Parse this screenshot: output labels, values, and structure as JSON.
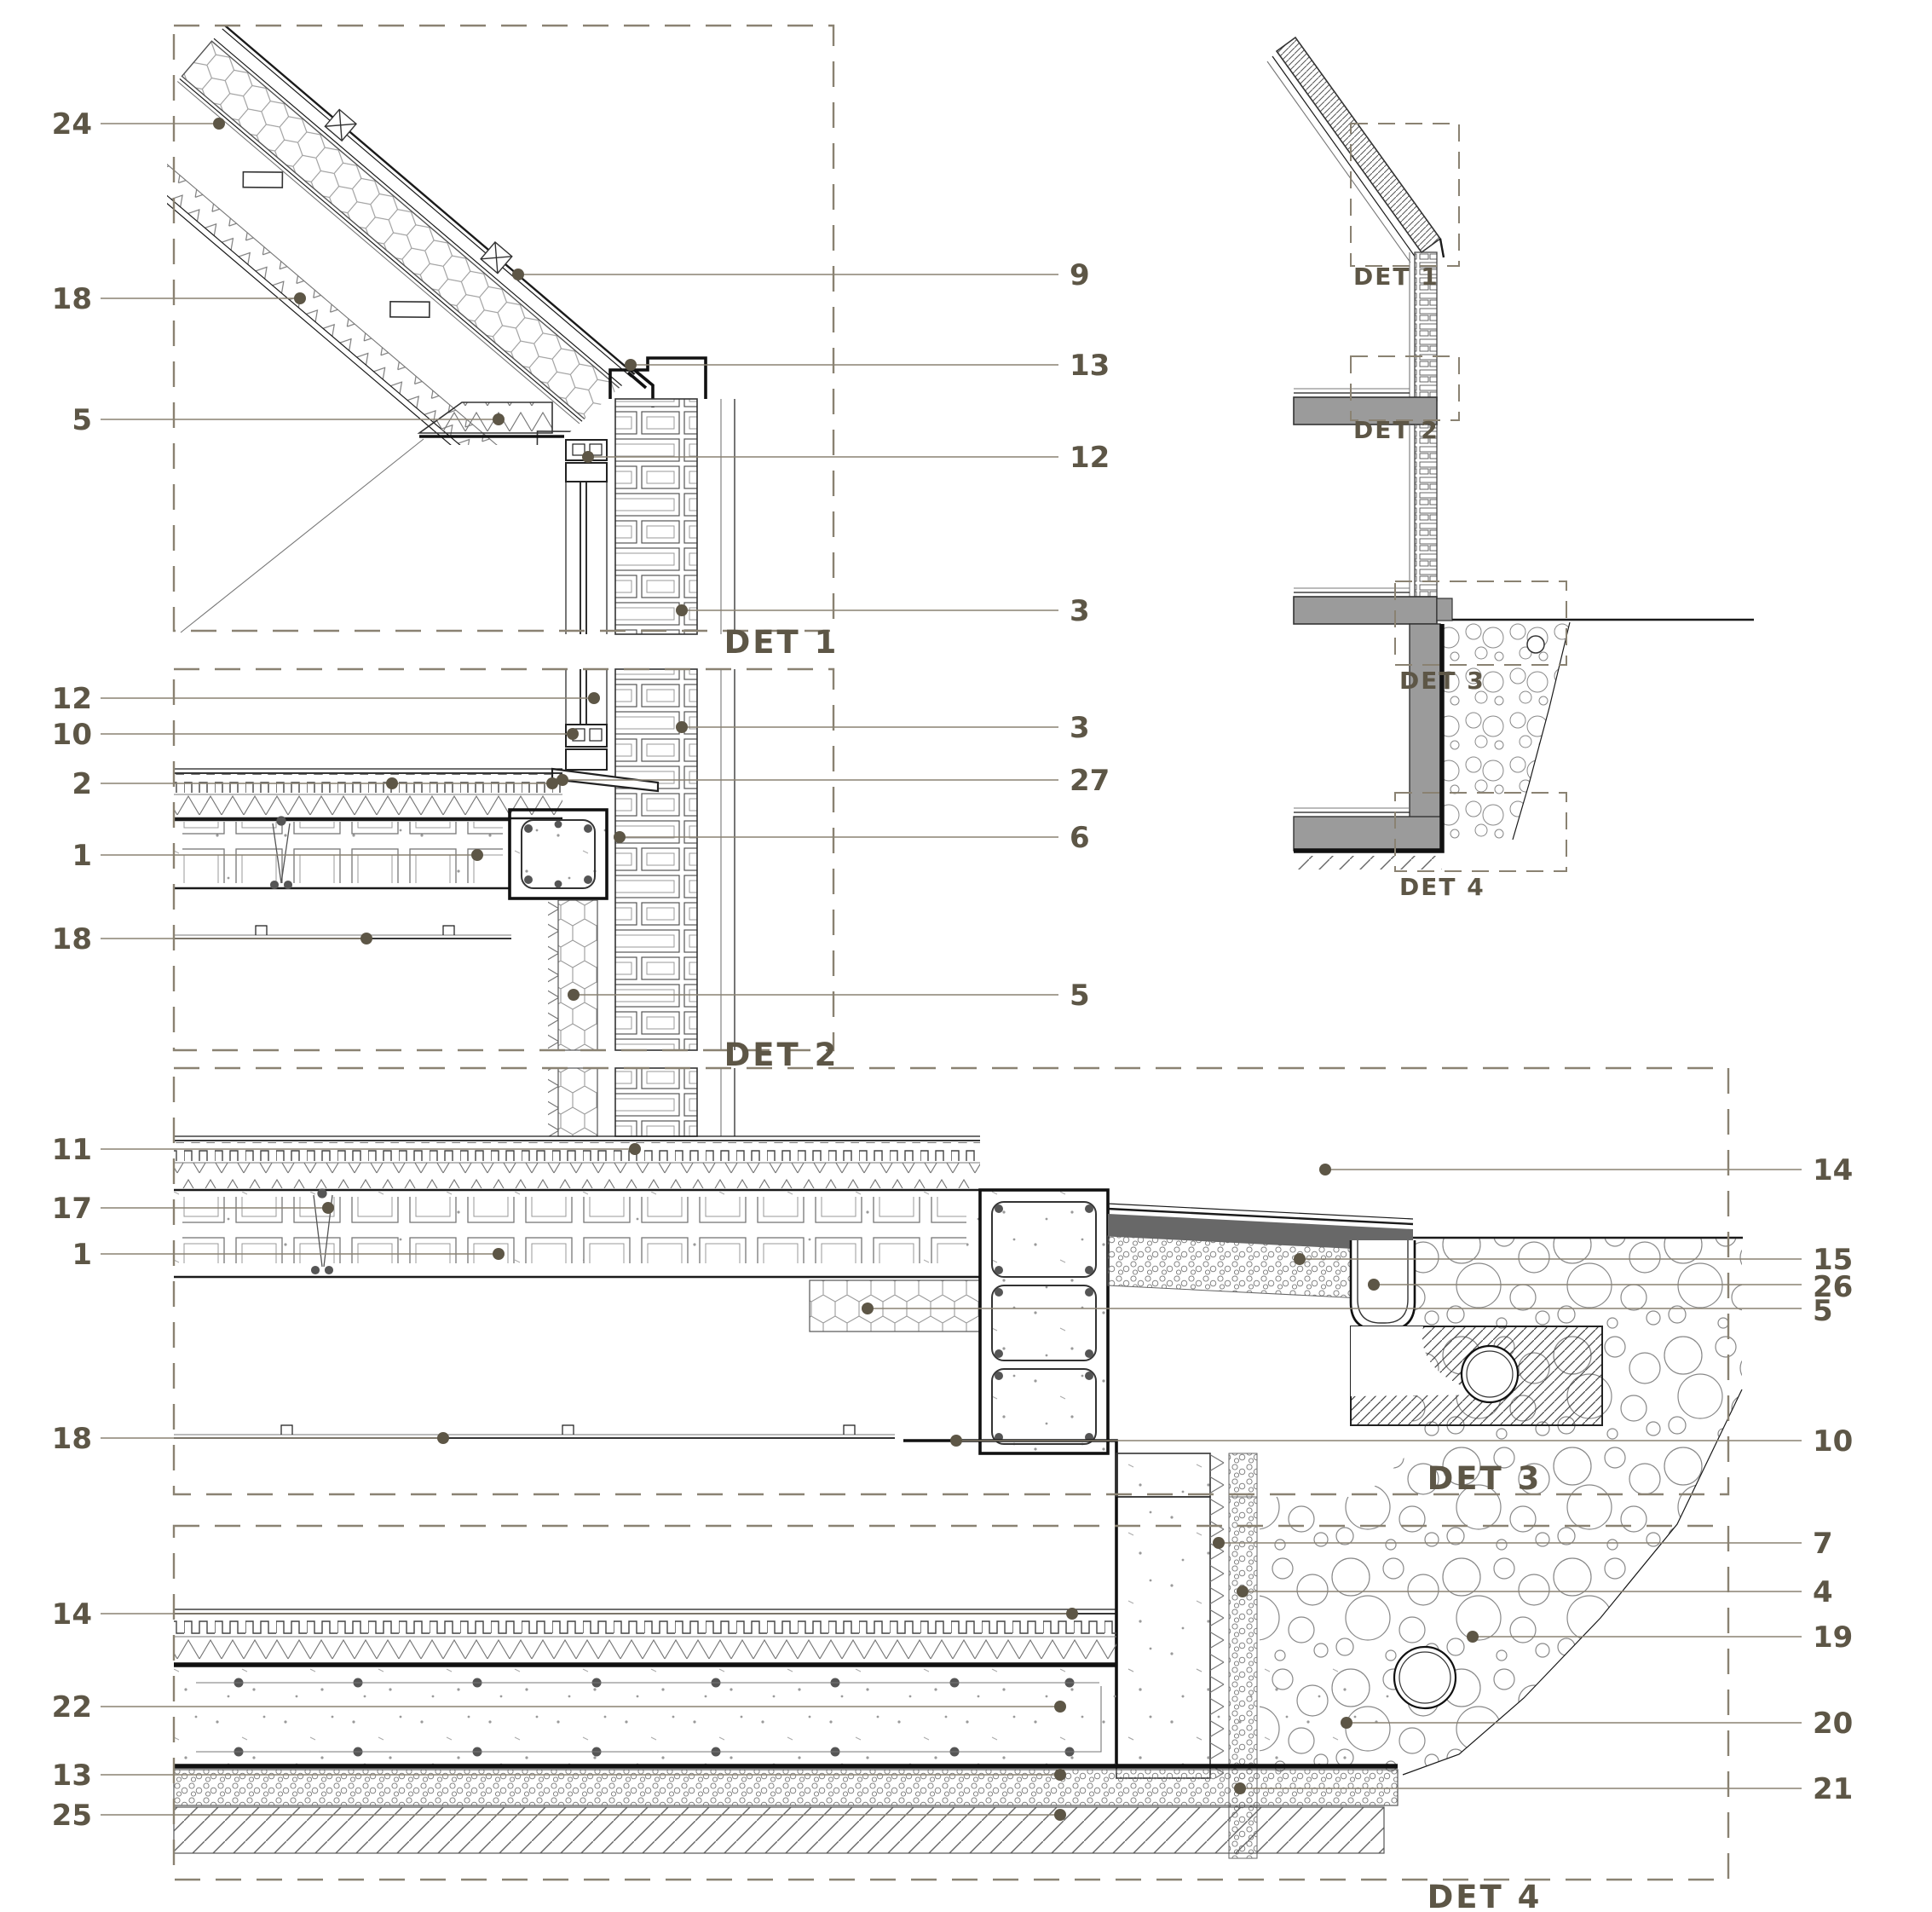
{
  "sheet": {
    "type": "architectural-construction-details",
    "colors": {
      "label": "#5d5646",
      "leader": "#8a8272",
      "linework": "#1a1a1a",
      "dash_border": "#8a8272",
      "slab_fill": "#9b9b9b",
      "waterproof_fill": "#686868",
      "background": "#ffffff"
    }
  },
  "captions": {
    "det1": "DET 1",
    "det2": "DET 2",
    "det3": "DET 3",
    "det4": "DET 4",
    "key_det1": "DET 1",
    "key_det2": "DET 2",
    "key_det3": "DET 3",
    "key_det4": "DET 4"
  },
  "callouts": [
    {
      "text": "24",
      "detail": "DET 1",
      "side": "left"
    },
    {
      "text": "18",
      "detail": "DET 1",
      "side": "left"
    },
    {
      "text": "5",
      "detail": "DET 1",
      "side": "left"
    },
    {
      "text": "12",
      "detail": "DET 2",
      "side": "left"
    },
    {
      "text": "10",
      "detail": "DET 2",
      "side": "left"
    },
    {
      "text": "2",
      "detail": "DET 2",
      "side": "left"
    },
    {
      "text": "1",
      "detail": "DET 2",
      "side": "left"
    },
    {
      "text": "18",
      "detail": "DET 2",
      "side": "left"
    },
    {
      "text": "11",
      "detail": "DET 3",
      "side": "left"
    },
    {
      "text": "17",
      "detail": "DET 3",
      "side": "left"
    },
    {
      "text": "1",
      "detail": "DET 3",
      "side": "left"
    },
    {
      "text": "18",
      "detail": "DET 3",
      "side": "left"
    },
    {
      "text": "14",
      "detail": "DET 4",
      "side": "left"
    },
    {
      "text": "22",
      "detail": "DET 4",
      "side": "left"
    },
    {
      "text": "13",
      "detail": "DET 4",
      "side": "left"
    },
    {
      "text": "25",
      "detail": "DET 4",
      "side": "left"
    },
    {
      "text": "9",
      "detail": "DET 1",
      "side": "right"
    },
    {
      "text": "13",
      "detail": "DET 1",
      "side": "right"
    },
    {
      "text": "12",
      "detail": "DET 1",
      "side": "right"
    },
    {
      "text": "3",
      "detail": "DET 1",
      "side": "right"
    },
    {
      "text": "3",
      "detail": "DET 2",
      "side": "right"
    },
    {
      "text": "27",
      "detail": "DET 2",
      "side": "right"
    },
    {
      "text": "6",
      "detail": "DET 2",
      "side": "right"
    },
    {
      "text": "5",
      "detail": "DET 2",
      "side": "right"
    },
    {
      "text": "14",
      "detail": "DET 3",
      "side": "right"
    },
    {
      "text": "15",
      "detail": "DET 3",
      "side": "right"
    },
    {
      "text": "26",
      "detail": "DET 3",
      "side": "right"
    },
    {
      "text": "5",
      "detail": "DET 3",
      "side": "right"
    },
    {
      "text": "10",
      "detail": "DET 3",
      "side": "right"
    },
    {
      "text": "7",
      "detail": "DET 4",
      "side": "right"
    },
    {
      "text": "4",
      "detail": "DET 4",
      "side": "right"
    },
    {
      "text": "19",
      "detail": "DET 4",
      "side": "right"
    },
    {
      "text": "20",
      "detail": "DET 4",
      "side": "right"
    },
    {
      "text": "21",
      "detail": "DET 4",
      "side": "right"
    }
  ]
}
